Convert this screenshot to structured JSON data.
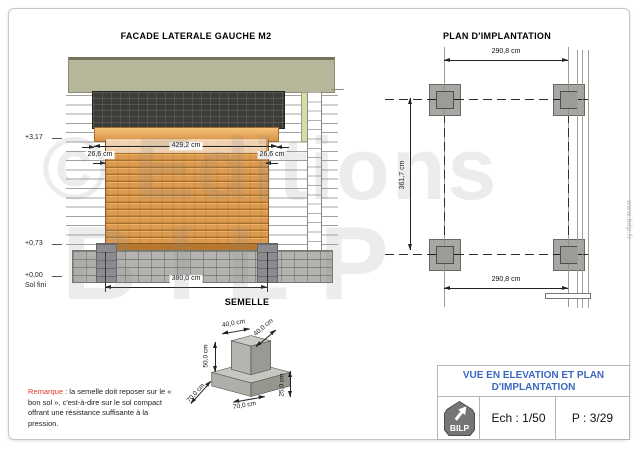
{
  "watermark": {
    "line1": "© Editions",
    "line2": "BILP",
    "site": "www.bilp.fr"
  },
  "facade": {
    "title": "FACADE LATERALE GAUCHE M2",
    "dim_top": "429,2 cm",
    "dim_overhang_left": "26,6 cm",
    "dim_overhang_right": "26,6 cm",
    "dim_bottom": "380,0 cm",
    "level_top": "+3,17",
    "level_mid": "+0,73",
    "level_zero": "+0,00",
    "level_zero_sub": "Sol fini"
  },
  "plan": {
    "title": "PLAN D'IMPLANTATION",
    "dim_top": "290,8 cm",
    "dim_bottom": "290,8 cm",
    "dim_left": "361,7 cm"
  },
  "semelle": {
    "title": "SEMELLE",
    "dim_pier_front": "40,0 cm",
    "dim_pier_side": "40,0 cm",
    "dim_pier_height": "50,0 cm",
    "dim_base_side": "70,0 cm",
    "dim_base_front": "70,0 cm",
    "dim_base_height": "25,0 cm"
  },
  "remark": {
    "label": "Remarque",
    "text": " : la semelle doit reposer sur le « bon sol », c'est-à-dire sur le sol compact offrant une résistance suffisante à la pression."
  },
  "titleblock": {
    "line1": "VUE EN ELEVATION ET PLAN",
    "line2": "D'IMPLANTATION",
    "scale": "Ech : 1/50",
    "page": "P : 3/29",
    "logo": "BILP",
    "accent": "#3a68c2"
  }
}
